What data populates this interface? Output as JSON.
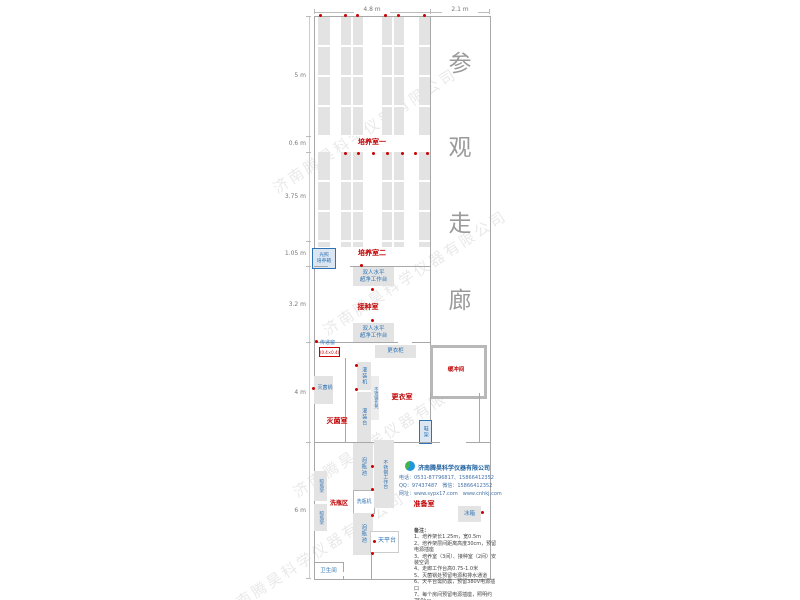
{
  "plan": {
    "top_dimensions": [
      "4.8 m",
      "2.1 m"
    ],
    "left_dimensions": [
      "5 m",
      "0.6 m",
      "3.75 m",
      "1.05 m",
      "3.2 m",
      "4 m",
      "6 m"
    ],
    "corridor_title": [
      "参",
      "观",
      "走",
      "廊"
    ],
    "watermark_text": "济南腾昊科学仪器有限公司"
  },
  "rooms": {
    "culture1": "培养室一",
    "culture2": "培养室二",
    "inoculation": "接种室",
    "sterilization": "灭菌室",
    "changing": "更衣室",
    "buffer": "缓冲间",
    "prep": "准备室",
    "washing": "洗瓶区",
    "toilet": "卫生间"
  },
  "equipment": {
    "light_incubator": [
      "光照",
      "培养箱"
    ],
    "clean_bench": [
      "双人水平",
      "超净工作台"
    ],
    "pass_window": "传递窗",
    "pass_window_size": "(0.4×0.4)",
    "wardrobe": "更衣柜",
    "sterilizer": "灭菌锅",
    "filling_machine": "灌装机",
    "ss_bench": "不锈钢长凳",
    "filling_table": "灌装台",
    "shoe_rack": "鞋架",
    "drying_rack": "晾瓶架",
    "soaking_pool": "泡瓶池",
    "bottle_washer": "洗瓶机",
    "ss_worktable": "不锈钢工作台",
    "balance_table": "天平台",
    "fridge": "冰箱"
  },
  "company": {
    "name": "济南腾昊科学仪器有限公司",
    "phone": "电话：0531-87796817、15866412352",
    "qq": "QQ：97437487　微信：15866412352",
    "website": "网址：www.sypx17.com　www.cnhkj.com"
  },
  "notes": {
    "title": "备注：",
    "items": [
      "1、培养架长1.25m，宽0.5m",
      "2、培养架层间距离高度30cm，预留电源插座",
      "3、培养室（3间）、接种室（2间）安装空调",
      "4、走廊工作台高0.75-1.0米",
      "5、灭菌锅处预留电源和排水通道",
      "6、天平台需防震，预留380V电源插口",
      "7、每个房间预留电源插座，照明约750lux",
      "8、培养室预留门洞做推拉门一扇，不靠小推车购买。"
    ]
  },
  "colors": {
    "room_label": "#c00000",
    "equipment_label": "#2e74b5",
    "rack_fill": "#e3e3e3",
    "wall": "#a8a8a8",
    "corridor_text": "#9a9a9a",
    "marker_dot": "#cc0000"
  }
}
